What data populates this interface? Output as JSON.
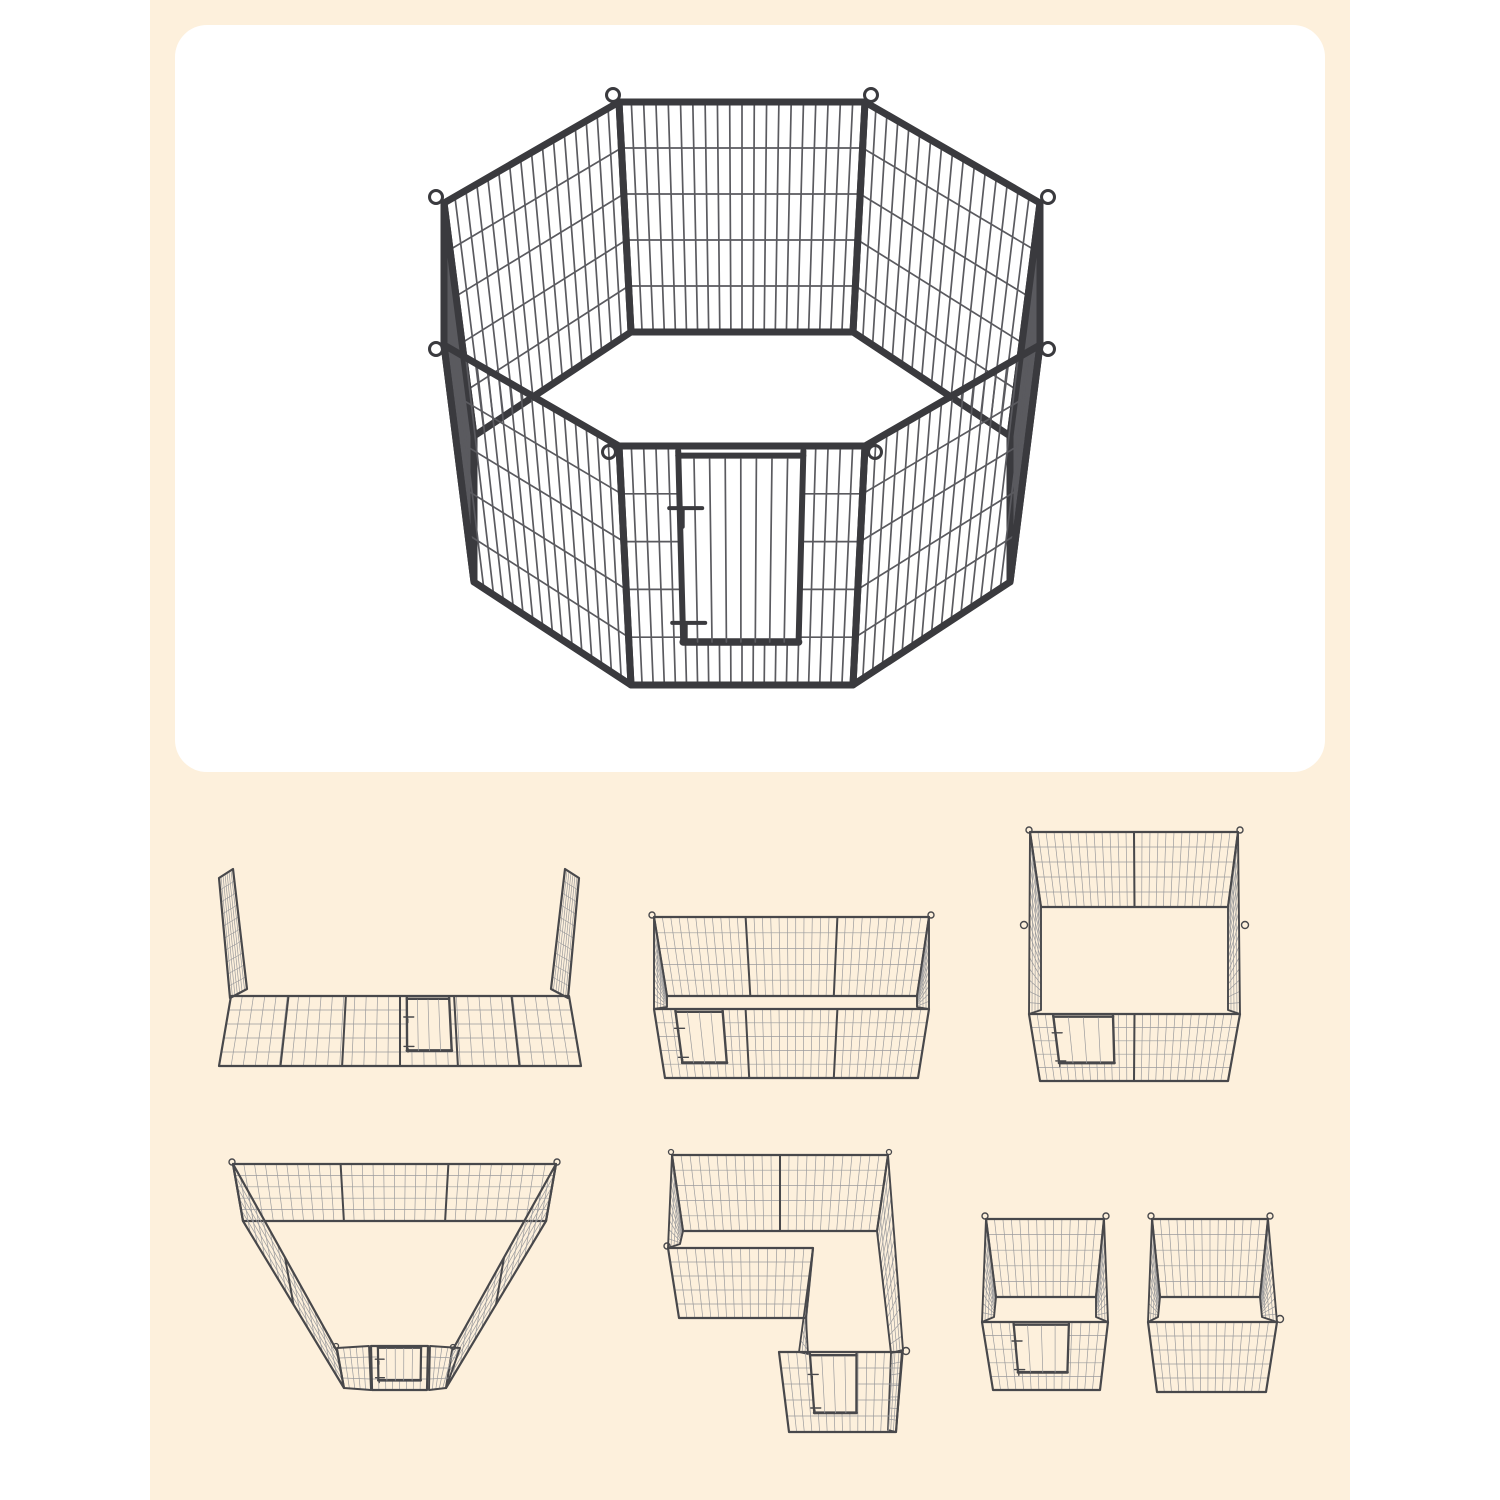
{
  "image": {
    "kind": "product-configuration-illustration",
    "subject": "8-panel heavy-duty metal pet playpen with lockable door",
    "canvas": {
      "width": 1500,
      "height": 1500
    }
  },
  "palette": {
    "page_bg": "#ffffff",
    "backdrop_bg": "#fdf0dc",
    "card_bg": "#ffffff",
    "hero_frame": "#3a3a3e",
    "hero_wire": "#5a5a5f",
    "sketch_frame": "#48484b",
    "sketch_wire": "#9b9b9d"
  },
  "hero": {
    "name": "octagon-playpen",
    "shape": "octagon",
    "panel_count": 8,
    "has_door": true,
    "door_latches": 2
  },
  "configurations": [
    {
      "name": "open-u-line",
      "shape": "open line with two raised end panels",
      "panel_count": 8,
      "has_door": true
    },
    {
      "name": "rectangle",
      "shape": "3x1 rectangle pen",
      "panel_count": 8,
      "has_door": true
    },
    {
      "name": "square",
      "shape": "2x2 square pen",
      "panel_count": 8,
      "has_door": true
    },
    {
      "name": "funnel",
      "shape": "trapezoid funnel pen",
      "panel_count": 8,
      "has_door": true
    },
    {
      "name": "l-shape",
      "shape": "L-shaped pen",
      "panel_count": 8,
      "has_door": true
    },
    {
      "name": "two-squares",
      "shape": "two separate 4-panel pens",
      "panel_count": 8,
      "has_door": true
    }
  ]
}
